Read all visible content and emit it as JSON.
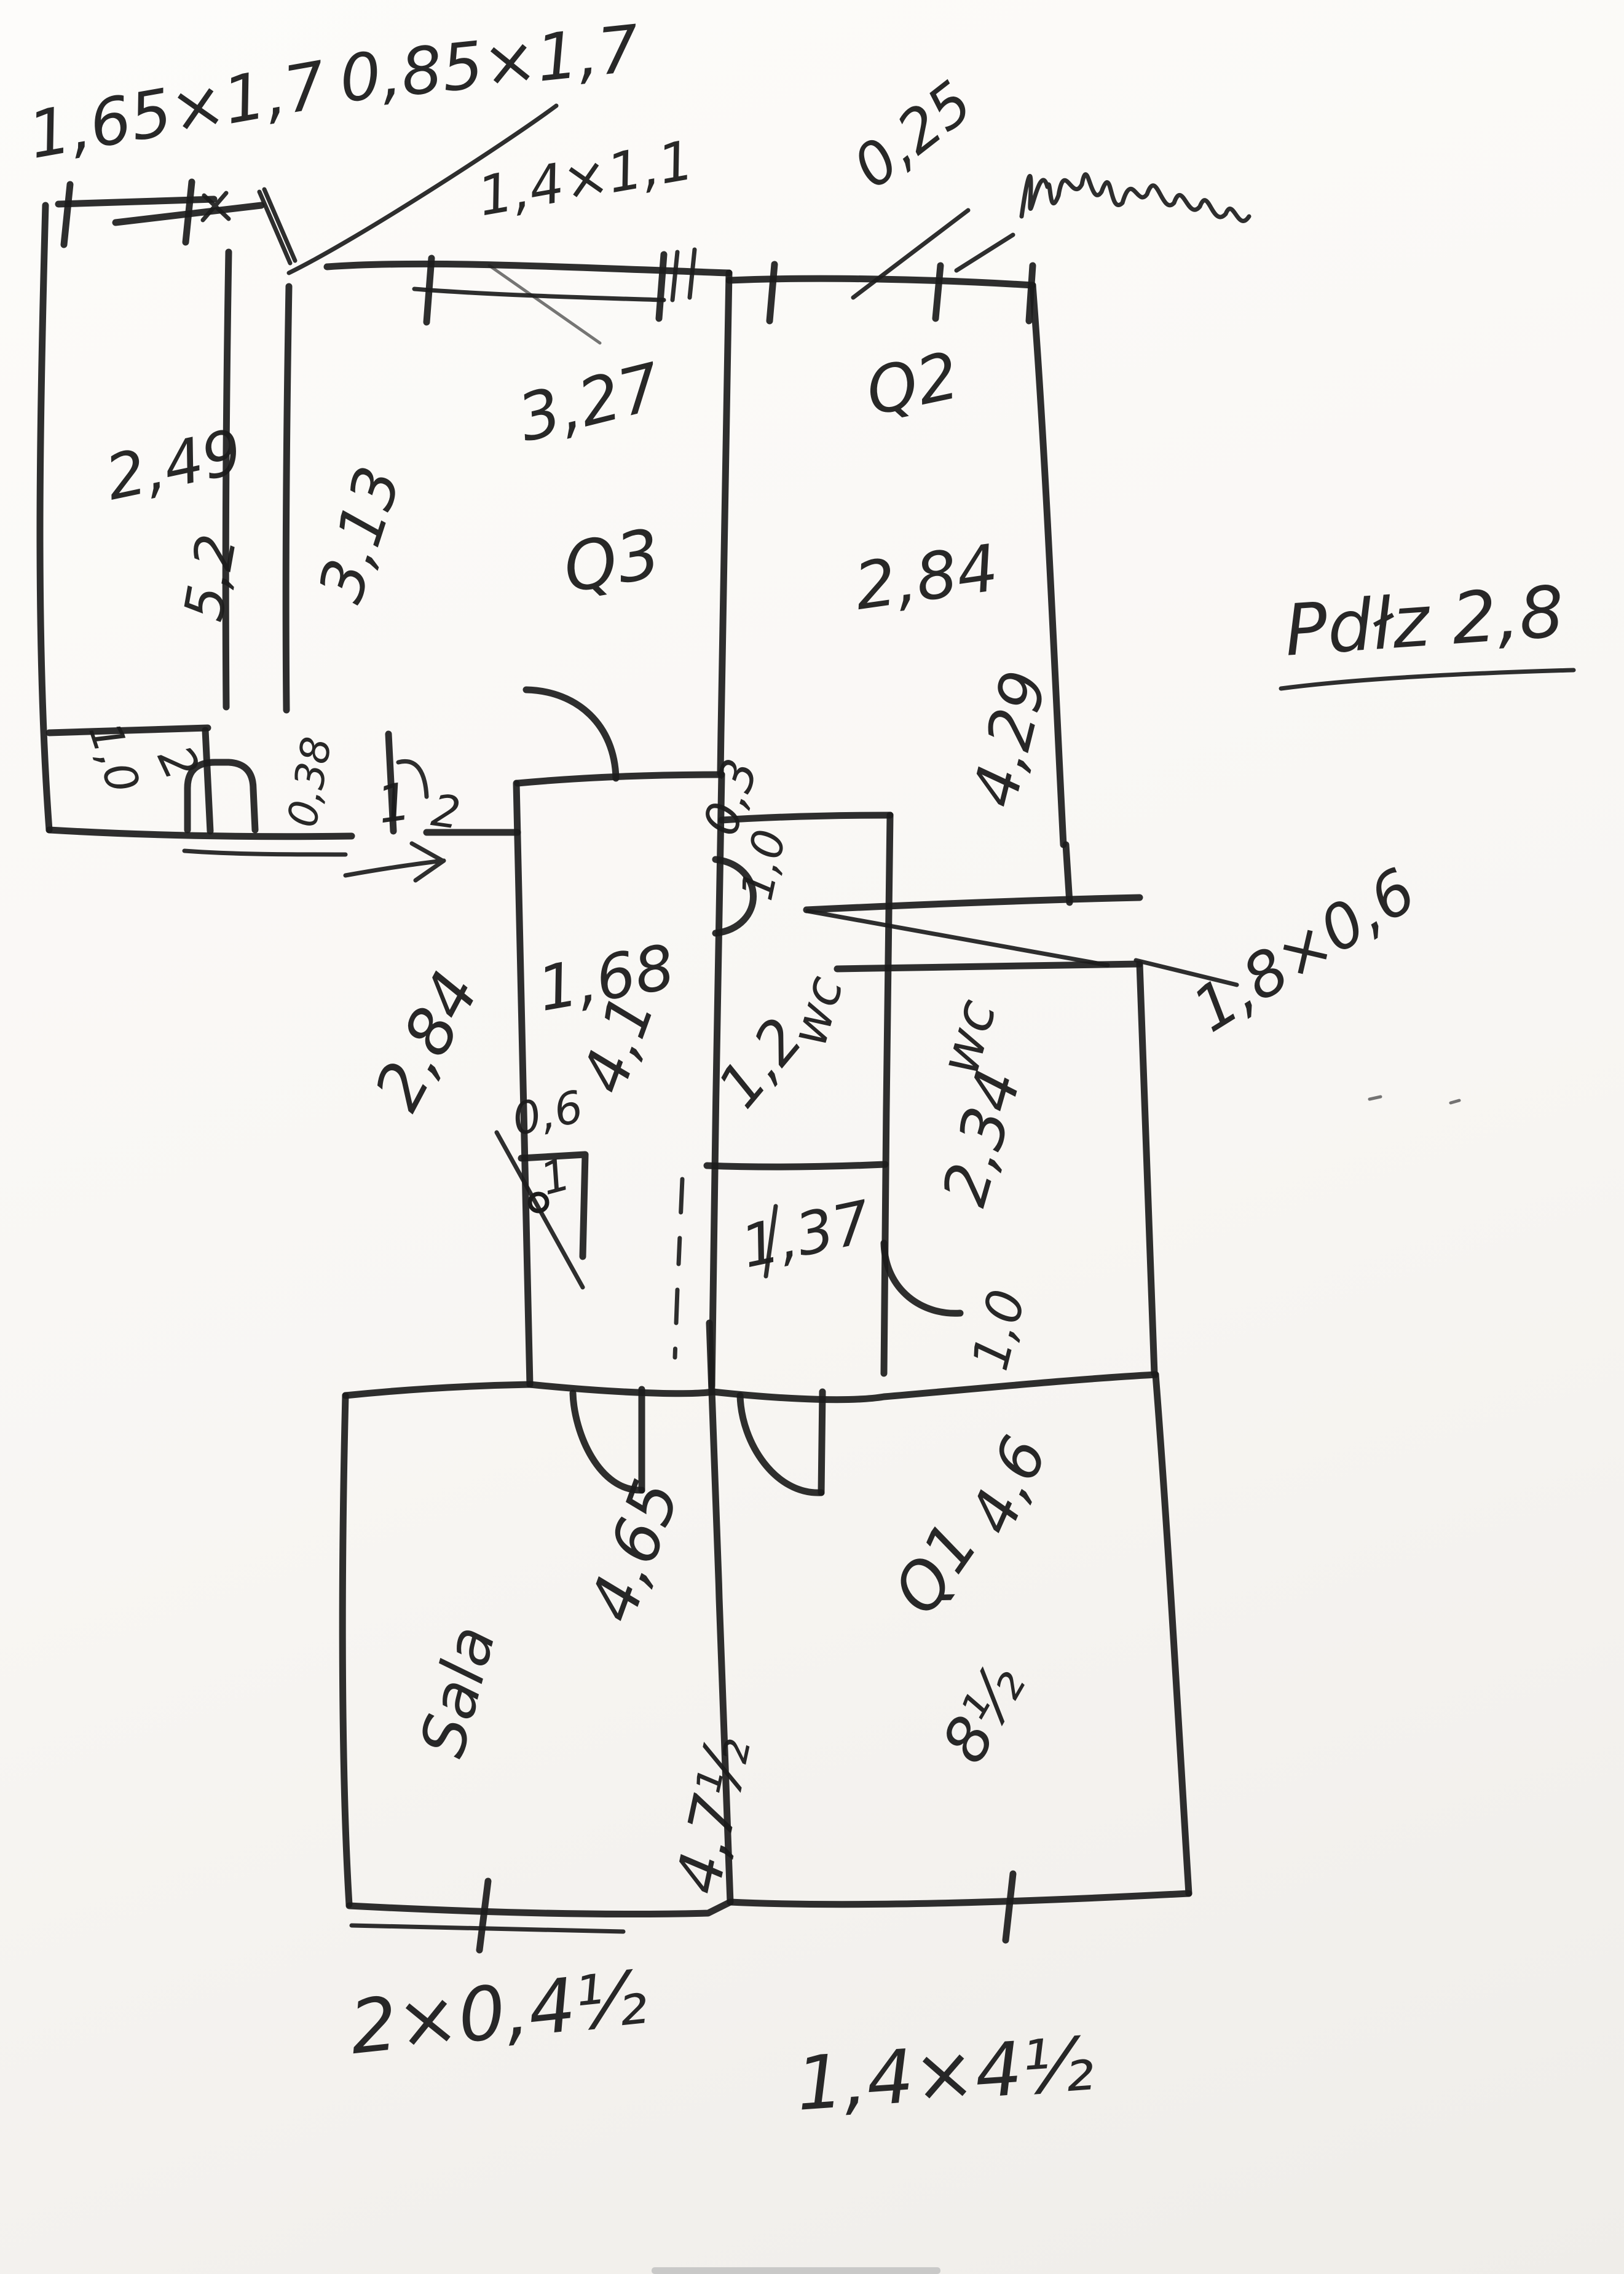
{
  "document": {
    "kind": "hand-drawn floor plan sketch, black pen on white paper",
    "ink_color": "#1c1c1c",
    "paper_color": "#f8f6f3"
  },
  "labels": {
    "dim_165x17": "1,65×1,7",
    "dim_085x17": "0,85×1,7",
    "dim_14x11": "1,4×1,1",
    "dim_025": "0,25",
    "scribble_note": "(illegible scribble)",
    "note_ceiling": "Pdłz 2,8",
    "room_tl_width": "2,49",
    "room_tl_height": "5,2",
    "room_mid_left": "3,13",
    "room_mid_width": "3,27",
    "room_mid_name": "Q3",
    "room_tr_name": "Q2",
    "room_tr_width": "2,84",
    "room_tr_height": "4,29",
    "niche_03": "0,3",
    "door_10": "1,0",
    "hall_width": "1,68",
    "hall_left": "2,84",
    "hall_height": "4,1",
    "wc1_name": "wc",
    "wc1_width": "1,2",
    "wc1_bottom": "1,37",
    "wc2_name": "wc",
    "wc2_height": "2,34",
    "wc2_door": "1,0",
    "dim_18x06": "1,8×0,6",
    "closet_06": "0,6",
    "closet_1": "1",
    "wall_038": "0,38",
    "entry_1": "1",
    "entry_2": "2",
    "alcove_10": "1,0",
    "alcove_2": "2",
    "room_bl_name": "Sala",
    "room_bl_width": "4,65",
    "room_bl_bottom": "4,7½",
    "room_br_width": "4,6",
    "room_br_name": "Q1",
    "room_br_bottom": "8½",
    "dim_bottom_left": "2×0,4½",
    "dim_bottom_right": "1,4×4½"
  }
}
